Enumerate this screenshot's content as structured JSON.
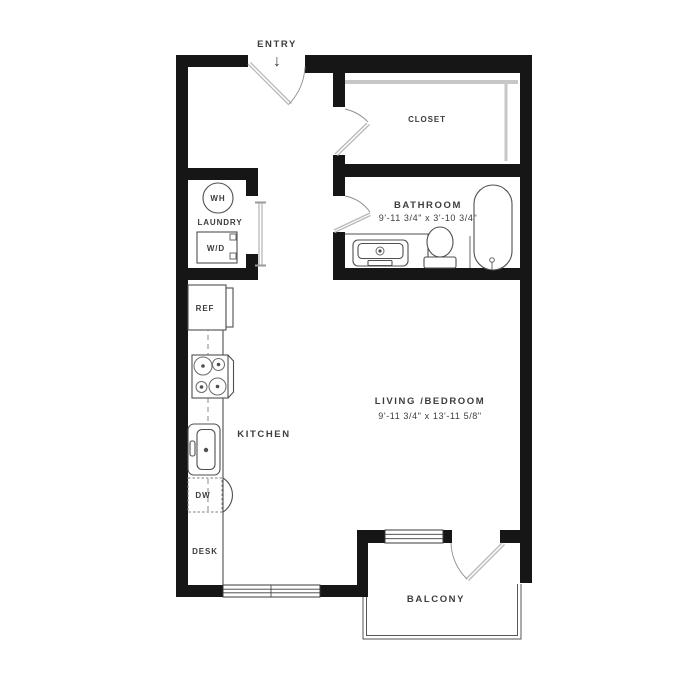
{
  "colors": {
    "wall": "#161616",
    "line": "#4f4f4f",
    "rod": "#c7c7c7",
    "door": "#b9b9b9",
    "text": "#3d3d3d",
    "bg": "#ffffff"
  },
  "plan": {
    "entry": {
      "label": "ENTRY",
      "arrow": "↓"
    },
    "closet": {
      "label": "CLOSET"
    },
    "laundry": {
      "label": "LAUNDRY",
      "water_heater": "WH",
      "washer_dryer": "W/D"
    },
    "bathroom": {
      "label": "BATHROOM",
      "dimensions": "9'-11 3/4\" x 3'-10 3/4\""
    },
    "kitchen": {
      "label": "KITCHEN",
      "refrigerator": "REF",
      "dishwasher": "DW",
      "desk": "DESK"
    },
    "living": {
      "label": "LIVING /BEDROOM",
      "dimensions": "9'-11 3/4\" x 13'-11 5/8\""
    },
    "balcony": {
      "label": "BALCONY"
    }
  }
}
